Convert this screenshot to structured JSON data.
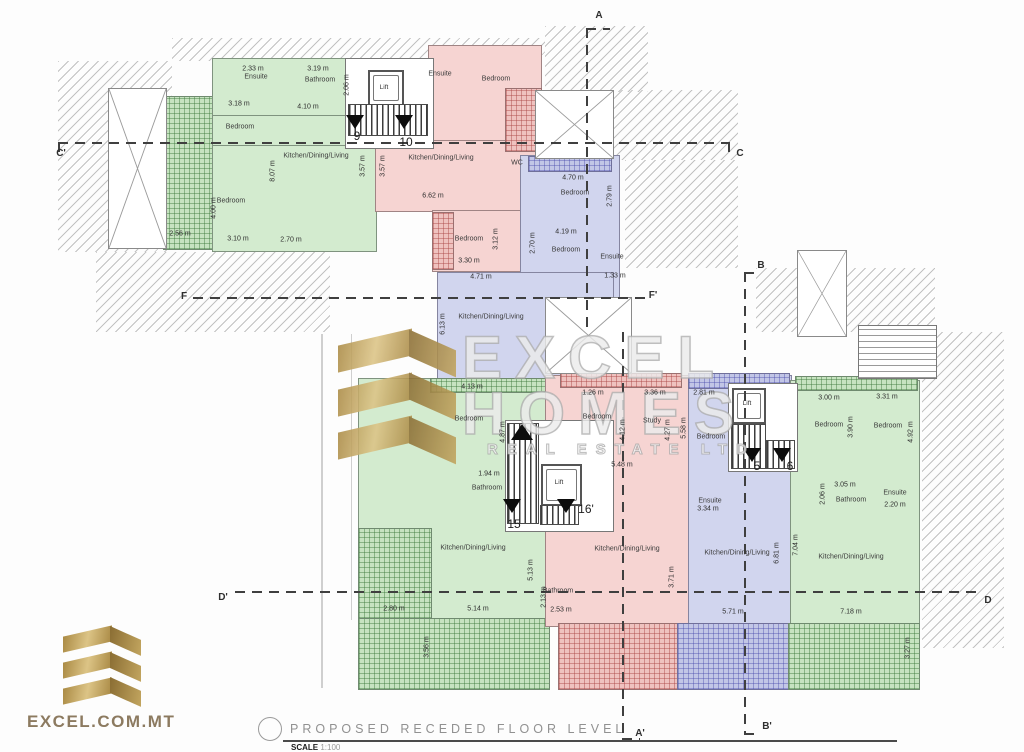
{
  "title_block": {
    "title": "PROPOSED RECEDED FLOOR LEVEL",
    "scale_label": "SCALE",
    "scale_value": "1:100"
  },
  "branding": {
    "logo_text": "EXCEL.COM.MT",
    "watermark_line1": "EXCEL",
    "watermark_line2": "HOMES",
    "watermark_line3": "REAL ESTATE LTD",
    "gold_color": "#b99a52"
  },
  "palette": {
    "green": "#d3ebcf",
    "pink": "#f6d4d2",
    "blue": "#d1d5ee",
    "hatch_line": "#919191"
  },
  "section_markers": [
    {
      "label": "A",
      "x": 599,
      "y": 16
    },
    {
      "label": "C'",
      "x": 61,
      "y": 154
    },
    {
      "label": "C",
      "x": 740,
      "y": 154
    },
    {
      "label": "B",
      "x": 761,
      "y": 266
    },
    {
      "label": "F",
      "x": 184,
      "y": 297
    },
    {
      "label": "F'",
      "x": 653,
      "y": 296
    },
    {
      "label": "D'",
      "x": 223,
      "y": 598
    },
    {
      "label": "D",
      "x": 988,
      "y": 601
    },
    {
      "label": "A'",
      "x": 640,
      "y": 734
    },
    {
      "label": "B'",
      "x": 767,
      "y": 727
    }
  ],
  "stair_numbers": [
    {
      "label": "9",
      "x": 357,
      "y": 136
    },
    {
      "label": "10",
      "x": 406,
      "y": 142
    },
    {
      "label": "15",
      "x": 514,
      "y": 524
    },
    {
      "label": "16'",
      "x": 586,
      "y": 509
    },
    {
      "label": "5",
      "x": 757,
      "y": 466
    },
    {
      "label": "6",
      "x": 790,
      "y": 466
    }
  ],
  "lift_labels": [
    {
      "text": "Lift",
      "x": 384,
      "y": 88
    },
    {
      "text": "Lift",
      "x": 559,
      "y": 483
    },
    {
      "text": "Lift",
      "x": 747,
      "y": 404
    }
  ],
  "room_labels": [
    {
      "text": "Ensuite",
      "x": 256,
      "y": 77
    },
    {
      "text": "Bathroom",
      "x": 320,
      "y": 80
    },
    {
      "text": "Bedroom",
      "x": 240,
      "y": 127
    },
    {
      "text": "Bedroom",
      "x": 231,
      "y": 201
    },
    {
      "text": "Kitchen/Dining/Living",
      "x": 316,
      "y": 156
    },
    {
      "text": "Ensuite",
      "x": 440,
      "y": 74
    },
    {
      "text": "Bedroom",
      "x": 496,
      "y": 79
    },
    {
      "text": "Kitchen/Dining/Living",
      "x": 441,
      "y": 158
    },
    {
      "text": "WC",
      "x": 517,
      "y": 163
    },
    {
      "text": "Bedroom",
      "x": 469,
      "y": 239
    },
    {
      "text": "Bedroom",
      "x": 575,
      "y": 193
    },
    {
      "text": "Bedroom",
      "x": 566,
      "y": 250
    },
    {
      "text": "Ensuite",
      "x": 612,
      "y": 257
    },
    {
      "text": "Kitchen/Dining/Living",
      "x": 491,
      "y": 317
    },
    {
      "text": "Bedroom",
      "x": 469,
      "y": 419
    },
    {
      "text": "Bathroom",
      "x": 487,
      "y": 488
    },
    {
      "text": "Kitchen/Dining/Living",
      "x": 473,
      "y": 548
    },
    {
      "text": "Bedroom",
      "x": 597,
      "y": 417
    },
    {
      "text": "Study",
      "x": 652,
      "y": 421
    },
    {
      "text": "Bathroom",
      "x": 558,
      "y": 591
    },
    {
      "text": "Kitchen/Dining/Living",
      "x": 627,
      "y": 549
    },
    {
      "text": "Bedroom",
      "x": 711,
      "y": 437
    },
    {
      "text": "Ensuite",
      "x": 710,
      "y": 501
    },
    {
      "text": "Kitchen/Dining/Living",
      "x": 737,
      "y": 553
    },
    {
      "text": "Bedroom",
      "x": 829,
      "y": 425
    },
    {
      "text": "Bedroom",
      "x": 888,
      "y": 426
    },
    {
      "text": "Bathroom",
      "x": 851,
      "y": 500
    },
    {
      "text": "Ensuite",
      "x": 895,
      "y": 493
    },
    {
      "text": "Kitchen/Dining/Living",
      "x": 851,
      "y": 557
    }
  ],
  "dim_labels": [
    {
      "text": "2.33 m",
      "x": 253,
      "y": 69,
      "rot": 0
    },
    {
      "text": "3.19 m",
      "x": 318,
      "y": 69,
      "rot": 0
    },
    {
      "text": "2.06 m",
      "x": 347,
      "y": 85,
      "rot": 1
    },
    {
      "text": "3.18 m",
      "x": 239,
      "y": 104,
      "rot": 0
    },
    {
      "text": "4.10 m",
      "x": 308,
      "y": 107,
      "rot": 0
    },
    {
      "text": "8.07 m",
      "x": 273,
      "y": 171,
      "rot": 1
    },
    {
      "text": "3.57 m",
      "x": 363,
      "y": 166,
      "rot": 1
    },
    {
      "text": "3.57 m",
      "x": 383,
      "y": 166,
      "rot": 1
    },
    {
      "text": "4.00 m",
      "x": 214,
      "y": 208,
      "rot": 1
    },
    {
      "text": "2.56 m",
      "x": 180,
      "y": 234,
      "rot": 0
    },
    {
      "text": "3.10 m",
      "x": 238,
      "y": 239,
      "rot": 0
    },
    {
      "text": "2.70 m",
      "x": 291,
      "y": 240,
      "rot": 0
    },
    {
      "text": "6.62 m",
      "x": 433,
      "y": 196,
      "rot": 0
    },
    {
      "text": "3.12 m",
      "x": 496,
      "y": 239,
      "rot": 1
    },
    {
      "text": "3.30 m",
      "x": 469,
      "y": 261,
      "rot": 0
    },
    {
      "text": "4.71 m",
      "x": 481,
      "y": 277,
      "rot": 0
    },
    {
      "text": "4.70 m",
      "x": 573,
      "y": 178,
      "rot": 0
    },
    {
      "text": "2.79 m",
      "x": 610,
      "y": 196,
      "rot": 1
    },
    {
      "text": "4.19 m",
      "x": 566,
      "y": 232,
      "rot": 0
    },
    {
      "text": "2.70 m",
      "x": 533,
      "y": 243,
      "rot": 1
    },
    {
      "text": "1.33 m",
      "x": 615,
      "y": 276,
      "rot": 0
    },
    {
      "text": "6.13 m",
      "x": 443,
      "y": 324,
      "rot": 1
    },
    {
      "text": "4.13 m",
      "x": 472,
      "y": 387,
      "rot": 0
    },
    {
      "text": "4.87 m",
      "x": 503,
      "y": 432,
      "rot": 1
    },
    {
      "text": "1.94 m",
      "x": 489,
      "y": 474,
      "rot": 0
    },
    {
      "text": "5.13 m",
      "x": 531,
      "y": 570,
      "rot": 1
    },
    {
      "text": "2.80 m",
      "x": 394,
      "y": 609,
      "rot": 0
    },
    {
      "text": "5.14 m",
      "x": 478,
      "y": 609,
      "rot": 0
    },
    {
      "text": "3.56 m",
      "x": 427,
      "y": 647,
      "rot": 1
    },
    {
      "text": "1.26 m",
      "x": 593,
      "y": 393,
      "rot": 0
    },
    {
      "text": "3.36 m",
      "x": 655,
      "y": 393,
      "rot": 0
    },
    {
      "text": "4.12 m",
      "x": 623,
      "y": 430,
      "rot": 1
    },
    {
      "text": "4.27 m",
      "x": 668,
      "y": 430,
      "rot": 1
    },
    {
      "text": "5.48 m",
      "x": 622,
      "y": 465,
      "rot": 0
    },
    {
      "text": "2.13 m",
      "x": 544,
      "y": 597,
      "rot": 1
    },
    {
      "text": "2.53 m",
      "x": 561,
      "y": 610,
      "rot": 0
    },
    {
      "text": "3.71 m",
      "x": 672,
      "y": 577,
      "rot": 1
    },
    {
      "text": "2.81 m",
      "x": 704,
      "y": 393,
      "rot": 0
    },
    {
      "text": "5.58 m",
      "x": 684,
      "y": 428,
      "rot": 1
    },
    {
      "text": "3.34 m",
      "x": 708,
      "y": 509,
      "rot": 0
    },
    {
      "text": "6.81 m",
      "x": 777,
      "y": 553,
      "rot": 1
    },
    {
      "text": "5.71 m",
      "x": 733,
      "y": 612,
      "rot": 0
    },
    {
      "text": "3.00 m",
      "x": 829,
      "y": 398,
      "rot": 0
    },
    {
      "text": "3.31 m",
      "x": 887,
      "y": 397,
      "rot": 0
    },
    {
      "text": "3.90 m",
      "x": 851,
      "y": 427,
      "rot": 1
    },
    {
      "text": "4.92 m",
      "x": 911,
      "y": 432,
      "rot": 1
    },
    {
      "text": "3.05 m",
      "x": 845,
      "y": 485,
      "rot": 0
    },
    {
      "text": "2.06 m",
      "x": 823,
      "y": 494,
      "rot": 1
    },
    {
      "text": "2.20 m",
      "x": 895,
      "y": 505,
      "rot": 0
    },
    {
      "text": "7.04 m",
      "x": 796,
      "y": 545,
      "rot": 1
    },
    {
      "text": "7.18 m",
      "x": 851,
      "y": 612,
      "rot": 0
    },
    {
      "text": "3.27 m",
      "x": 908,
      "y": 648,
      "rot": 1
    }
  ]
}
